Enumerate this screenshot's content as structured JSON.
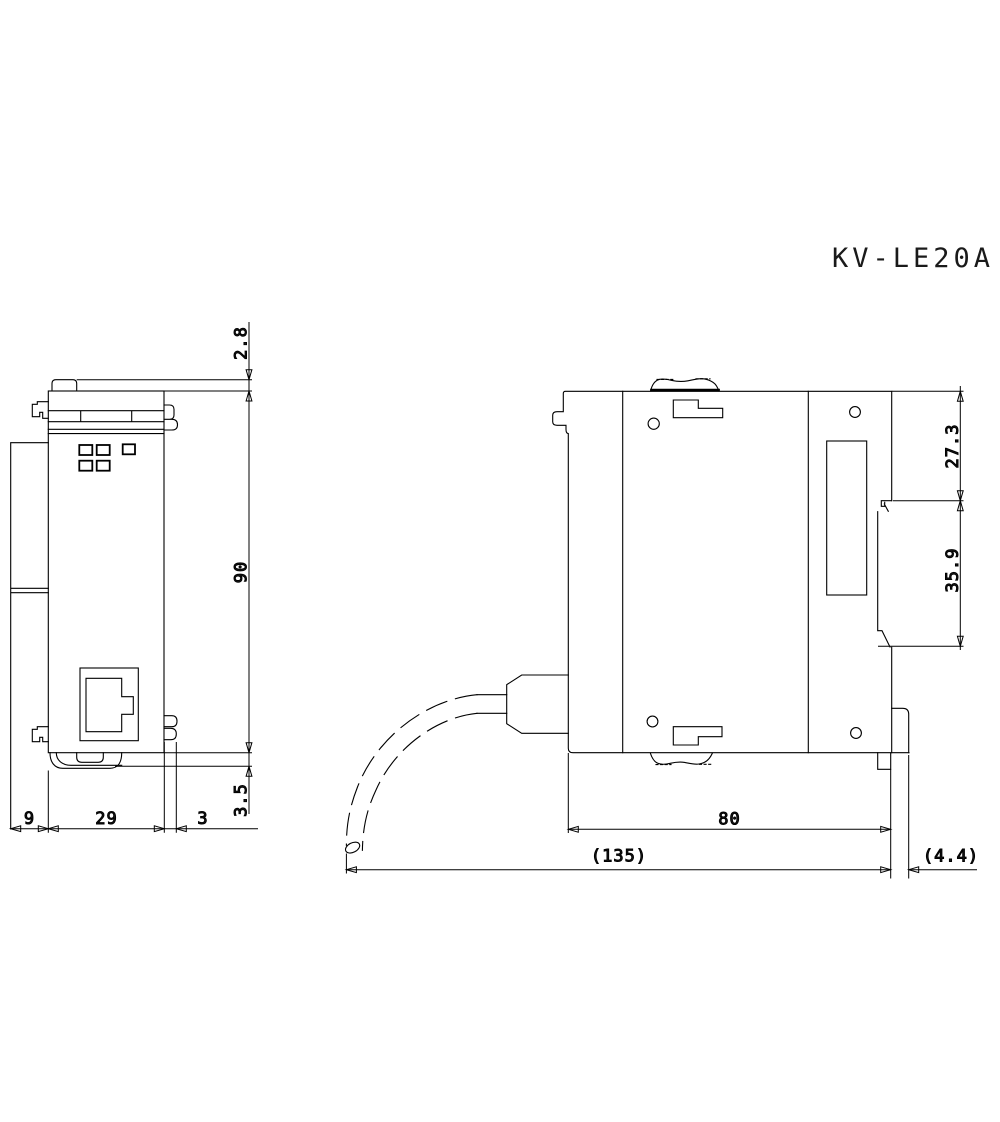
{
  "drawing": {
    "title": "KV-LE20A",
    "front_view": {
      "dim_top_tab_height": "2.8",
      "dim_body_height": "90",
      "dim_bottom_latch_height": "3.5",
      "dim_left_protrusion_width": "9",
      "dim_body_width": "29",
      "dim_right_connector_width": "3"
    },
    "side_view": {
      "dim_upper_section_height": "27.3",
      "dim_din_rail_section_height": "35.9",
      "dim_body_depth": "80",
      "dim_overall_depth_with_cable": "(135)",
      "dim_release_tab_depth": "(4.4)"
    },
    "colors": {
      "line": "#000000",
      "background": "#ffffff"
    }
  }
}
